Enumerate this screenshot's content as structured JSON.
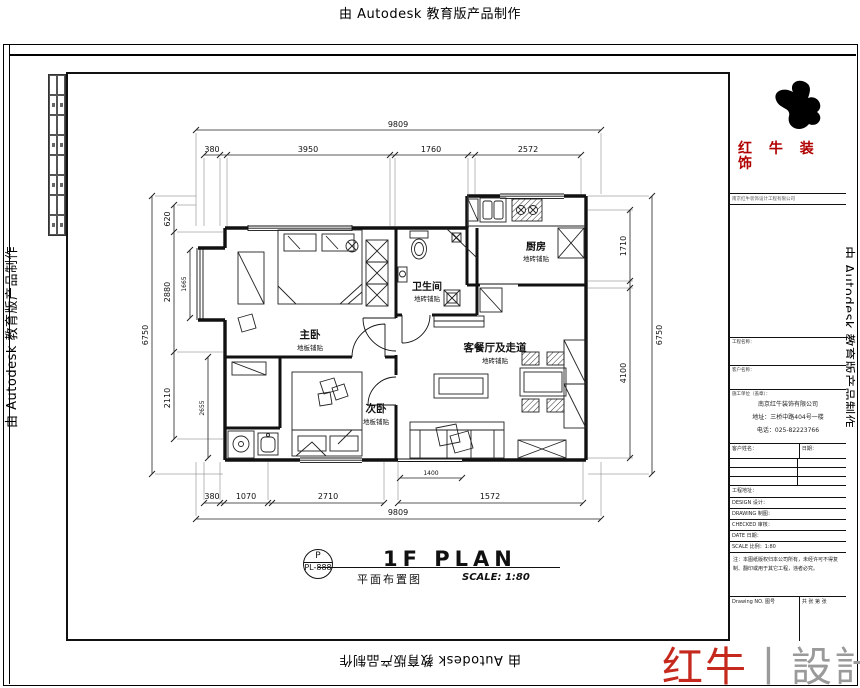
{
  "watermarks": {
    "top": "由 Autodesk 教育版产品制作",
    "bottom": "由 Autodesk 教育版产品制作",
    "left": "由 Autodesk 教育版产品制作",
    "right": "由 Autodesk 教育版产品制作"
  },
  "plan": {
    "rooms": [
      {
        "name": "主卧",
        "finish": "地板铺贴"
      },
      {
        "name": "次卧",
        "finish": "地板铺贴"
      },
      {
        "name": "卫生间",
        "finish": "地砖铺贴"
      },
      {
        "name": "厨房",
        "finish": "地砖铺贴"
      },
      {
        "name": "客餐厅及走道",
        "finish": "地砖铺贴"
      }
    ],
    "dims": {
      "top_total": "9809",
      "top_segments": [
        "380",
        "3950",
        "1760",
        "2572"
      ],
      "bottom_segments": [
        "380",
        "1070",
        "2710",
        "1572"
      ],
      "bottom_total": "9809",
      "left_total": "6750",
      "left_segments": [
        "620",
        "2880",
        "2110"
      ],
      "right_total": "6750",
      "right_segments": [
        "1710",
        "4100"
      ],
      "inner": [
        "1665",
        "2655",
        "1400"
      ]
    }
  },
  "title": {
    "stamp_letter": "P",
    "stamp_code": "PL-888",
    "main": "1F PLAN",
    "cn": "平面布置图",
    "scale": "SCALE: 1:80"
  },
  "titleblock": {
    "brand_line1": "红 牛 装",
    "brand_line2": "饰",
    "brand_small": "南京红牛装饰设计工程有限公司",
    "field_project": "工程名称：",
    "field_client": "客户名称：",
    "company_header": "施工单位（盖章）：",
    "company_name": "南京红牛装饰有限公司",
    "company_addr": "地址：三桥中路404号一楼",
    "company_tel": "电话：025-82223766",
    "row_name": "客户姓名：",
    "row_date": "日期：",
    "row_address": "工程地址：",
    "row_design": "DESIGN 设计：",
    "row_drawing": "DRAWING 制图：",
    "row_checked": "CHECKED 审核：",
    "row_date2": "DATE 日期：",
    "row_scale": "SCALE 比例：1:80",
    "note": "注：本图纸版权归本公司所有，未经许可不得复制、翻印或用于其它工程，违者必究。",
    "drawing_no": "Drawing NO. 图号",
    "sheet": "共 张 第 张"
  },
  "footer": {
    "brand_red": "红牛",
    "divider": "丨",
    "brand_gray": "設計"
  },
  "colors": {
    "brand_red": "#c5281c",
    "line": "#111111"
  }
}
